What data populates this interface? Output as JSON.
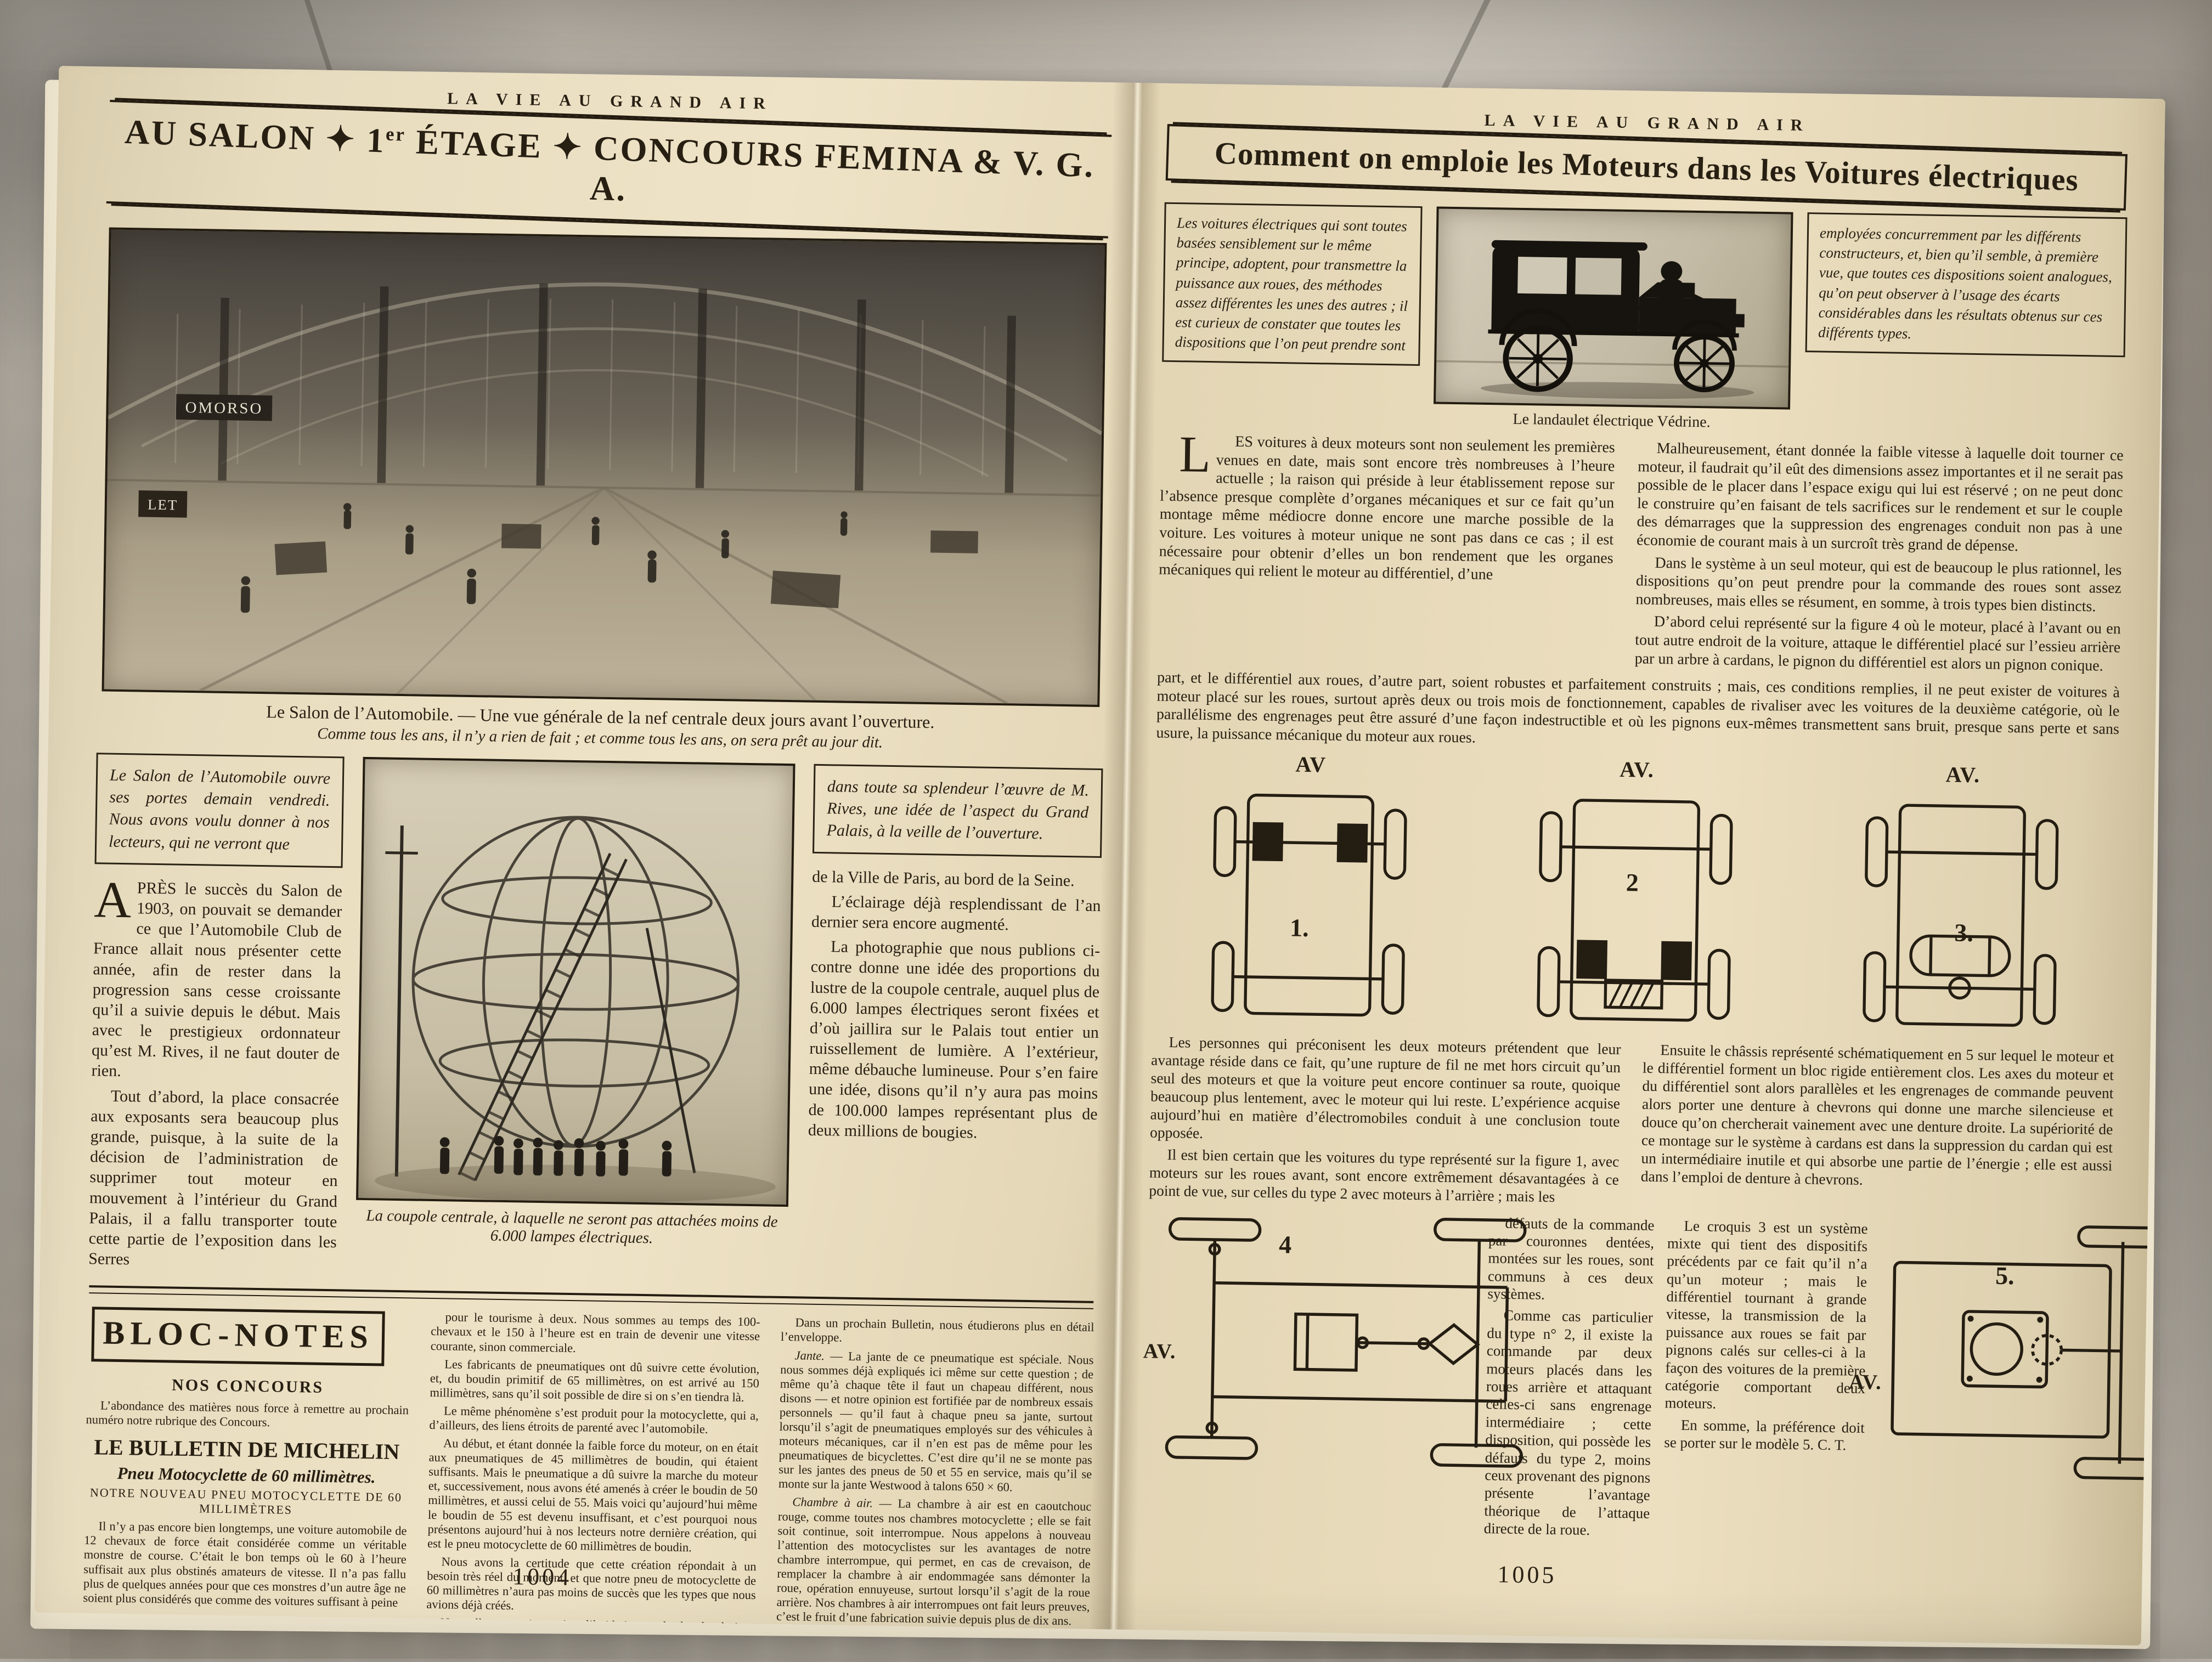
{
  "left_page": {
    "masthead": "LA VIE AU GRAND AIR",
    "title_p1": "AU SALON ✦ 1",
    "title_sup": "er",
    "title_p2": " ÉTAGE ✦ CONCOURS FEMINA & V. G. A.",
    "photo1": {
      "sign1": "OMORSO",
      "sign2": "LET",
      "caption_main": "Le Salon de l’Automobile. — Une vue générale de la nef centrale deux jours avant l’ouverture.",
      "caption_sub": "Comme tous les ans, il n’y a rien de fait ; et comme tous les ans, on sera prêt au jour dit."
    },
    "intro_box_left": "Le Salon de l’Automobile ouvre ses portes demain vendredi. Nous avons voulu donner à nos lecteurs, qui ne verront que",
    "intro_box_right": "dans toute sa splendeur l’œuvre de M. Rives, une idée de l’aspect du Grand Palais, à la veille de l’ouverture.",
    "article": {
      "dropcap": "A",
      "p1_rest": "PRÈS le succès du Salon de 1903, on pouvait se demander ce que l’Automobile Club de France allait nous présenter cette année, afin de rester dans la progression sans cesse croissante qu’il a suivie depuis le début. Mais avec le prestigieux ordonnateur qu’est M. Rives, il ne faut douter de rien.",
      "p2": "Tout d’abord, la place consacrée aux exposants sera beaucoup plus grande, puisque, à la suite de la décision de l’administration de supprimer tout moteur en mouvement à l’intérieur du Grand Palais, il a fallu transporter toute cette partie de l’exposition dans les Serres",
      "right_p1": "de la Ville de Paris, au bord de la Seine.",
      "right_p2": "L’éclairage déjà resplendissant de l’an dernier sera encore augmenté.",
      "right_p3": "La photographie que nous publions ci-contre donne une idée des proportions du lustre de la coupole centrale, auquel plus de 6.000 lampes électriques seront fixées et d’où jaillira sur le Palais tout entier un ruissellement de lumière. A l’extérieur, même débauche lumineuse. Pour s’en faire une idée, disons qu’il n’y aura pas moins de 100.000 lampes représentant plus de deux millions de bougies."
    },
    "photo2_caption": "La coupole centrale, à laquelle ne seront pas attachées moins de 6.000 lampes électriques.",
    "bloc_notes": {
      "title": "BLOC-NOTES",
      "h_concours": "NOS CONCOURS",
      "p_concours": "L’abondance des matières nous force à remettre au prochain numéro notre rubrique des Concours.",
      "h_michelin": "LE BULLETIN DE MICHELIN",
      "h_pneu": "Pneu Motocyclette de 60 millimètres.",
      "h_notre": "NOTRE NOUVEAU PNEU MOTOCYCLETTE DE 60 MILLIMÈTRES",
      "c1p1": "Il n’y a pas encore bien longtemps, une voiture automobile de 12 chevaux de force était considérée comme un véritable monstre de course. C’était le bon temps où le 60 à l’heure suffisait aux plus obstinés amateurs de vitesse. Il n’a pas fallu plus de quelques années pour que ces monstres d’un autre âge ne soient plus considérés que comme des voitures suffisant à peine",
      "c2p1": "pour le tourisme à deux. Nous sommes au temps des 100-chevaux et le 150 à l’heure est en train de devenir une vitesse courante, sinon commerciale.",
      "c2p2": "Les fabricants de pneumatiques ont dû suivre cette évolution, et, du boudin primitif de 65 millimètres, on est arrivé au 150 millimètres, sans qu’il soit possible de dire si on s’en tiendra là.",
      "c2p3": "Le même phénomène s’est produit pour la motocyclette, qui a, d’ailleurs, des liens étroits de parenté avec l’automobile.",
      "c2p4": "Au début, et étant donnée la faible force du moteur, on en était aux pneumatiques de 45 millimètres de boudin, qui étaient suffisants. Mais le pneumatique a dû suivre la marche du moteur et, successivement, nous avons été amenés à créer le boudin de 50 millimètres, et aussi celui de 55. Mais voici qu’aujourd’hui même le boudin de 55 est devenu insuffisant, et c’est pourquoi nous présentons aujourd’hui à nos lecteurs notre dernière création, qui est le pneu motocyclette de 60 millimètres de boudin.",
      "c2p5": "Nous avons la certitude que cette création répondait à un besoin très réel du moment, et que notre pneu de motocyclette de 60 millimètres n’aura pas moins de succès que les types que nous avions déjà créés.",
      "c2p6": "Nous allons examiner aujourd’hui la jante et la chambre à air.",
      "c3p1": "Dans un prochain Bulletin, nous étudierons plus en détail l’enveloppe.",
      "jante_label": "Jante.",
      "jante_text": " — La jante de ce pneumatique est spéciale. Nous nous sommes déjà expliqués ici même sur cette question ; de même qu’à chaque tête il faut un chapeau différent, nous disons — et notre opinion est fortifiée par de nombreux essais personnels — qu’il faut à chaque pneu sa jante, surtout lorsqu’il s’agit de pneumatiques employés sur des véhicules à moteurs mécaniques, car il n’en est pas de même pour les pneumatiques de bicyclettes. C’est dire qu’il ne se monte pas sur les jantes des pneus de 50 et 55 en service, mais qu’il se monte sur la jante Westwood à talons 650 × 60.",
      "chambre_label": "Chambre à air.",
      "chambre_text": " — La chambre à air est en caoutchouc rouge, comme toutes nos chambres motocyclette ; elle se fait soit continue, soit interrompue. Nous appelons à nouveau l’attention des motocyclistes sur les avantages de notre chambre interrompue, qui permet, en cas de crevaison, de remplacer la chambre à air endommagée sans démonter la roue, opération ennuyeuse, surtout lorsqu’il s’agit de la roue arrière. Nos chambres à air interrompues ont fait leurs preuves, c’est le fruit d’une fabrication suivie depuis plus de dix ans.",
      "signature": "Michelin et Cie."
    },
    "page_number": "1004"
  },
  "right_page": {
    "masthead": "LA VIE AU GRAND AIR",
    "title": "Comment on emploie les Moteurs dans les Voitures électriques",
    "intro_box_left": "Les voitures électriques qui sont toutes basées sensiblement sur le même principe, adoptent, pour transmettre la puissance aux roues, des méthodes assez différentes les unes des autres ; il est curieux de constater que toutes les dispositions que l’on peut prendre sont",
    "intro_box_right": "employées concurremment par les différents constructeurs, et, bien qu’il semble, à première vue, que toutes ces dispositions soient analogues, qu’on peut observer à l’usage des écarts considérables dans les résultats obtenus sur ces différents types.",
    "photo_caption": "Le landaulet électrique Védrine.",
    "article": {
      "dropcap": "L",
      "p1_rest": "ES voitures à deux moteurs sont non seulement les premières venues en date, mais sont encore très nombreuses à l’heure actuelle ; la raison qui préside à leur établissement repose sur l’absence presque complète d’organes mécaniques et sur ce fait qu’un montage même médiocre donne encore une marche possible de la voiture. Les voitures à moteur unique ne sont pas dans ce cas ; il est nécessaire pour obtenir d’elles un bon rendement que les organes mécaniques qui relient le moteur au différentiel, d’une",
      "right_p1": "Malheureusement, étant donnée la faible vitesse à laquelle doit tourner ce moteur, il faudrait qu’il eût des dimensions assez importantes et il ne serait pas possible de le placer dans l’espace exigu qui lui est réservé ; on ne peut donc le construire qu’en faisant de tels sacrifices sur le rendement et sur le couple des démarrages que la suppression des engrenages conduit non pas à une économie de courant mais à un surcroît très grand de dépense.",
      "right_p2": "Dans le système à un seul moteur, qui est de beaucoup le plus rationnel, les dispositions qu’on peut prendre pour la commande des roues sont assez nombreuses, mais elles se résument, en somme, à trois types bien distincts.",
      "right_p3": "D’abord celui représenté sur la figure 4 où le moteur, placé à l’avant ou en tout autre endroit de la voiture, attaque le différentiel placé sur l’essieu arrière par un arbre à cardans, le pignon du différentiel est alors un pignon conique.",
      "full_p": "part, et le différentiel aux roues, d’autre part, soient robustes et parfaitement construits ; mais, ces conditions remplies, il ne peut exister de voitures à moteur placé sur les roues, surtout après deux ou trois mois de fonctionnement, capables de rivaliser avec les voitures de la deuxième catégorie, où le parallélisme des engrenages peut être assuré d’une façon indestructible et où les pignons eux-mêmes transmettent sans bruit, presque sans perte et sans usure, la puissance mécanique du moteur aux roues.",
      "mid_left_p1": "Les personnes qui préconisent les deux moteurs prétendent que leur avantage réside dans ce fait, qu’une rupture de fil ne met hors circuit qu’un seul des moteurs et que la voiture peut encore continuer sa route, quoique beaucoup plus lentement, avec le moteur qui lui reste. L’expérience acquise aujourd’hui en matière d’électromobiles conduit à une conclusion toute opposée.",
      "mid_left_p2": "Il est bien certain que les voitures du type représenté sur la figure 1, avec moteurs sur les roues avant, sont encore extrêmement désavantagées à ce point de vue, sur celles du type 2 avec moteurs à l’arrière ; mais les",
      "mid_right_p1": "Ensuite le châssis représenté schématiquement en 5 sur lequel le moteur et le différentiel forment un bloc rigide entièrement clos. Les axes du moteur et du différentiel sont alors parallèles et les engrenages de commande peuvent alors porter une denture à chevrons qui donne une marche silencieuse et douce qu’on chercherait vainement avec une denture droite. La supériorité de ce montage sur le système à cardans est dans la suppression du cardan qui est un intermédiaire inutile et qui absorbe une partie de l’énergie ; elle est aussi dans l’emploi de denture à chevrons.",
      "bottom_a_p1": "défauts de la commande par couronnes dentées, montées sur les roues, sont communs à ces deux systèmes.",
      "bottom_a_p2": "Comme cas particulier du type n° 2, il existe la commande par deux moteurs placés dans les roues arrière et attaquant celles-ci sans engrenage intermédiaire ; cette disposition, qui possède les défauts du type 2, moins ceux provenant des pignons présente l’avantage théorique de l’attaque directe de la roue.",
      "bottom_b_p1": "Le croquis 3 est un système mixte qui tient des dispositifs précédents par ce fait qu’il n’a qu’un moteur ; mais le différentiel tournant à grande vitesse, la transmission de la puissance aux roues se fait par pignons calés sur celles-ci à la façon des voitures de la première catégorie comportant deux moteurs.",
      "bottom_b_p2": "En somme, la préférence doit se porter sur le modèle 5. C. T."
    },
    "diagrams": {
      "av1": "AV",
      "n1": "1.",
      "av2": "AV.",
      "n2": "2",
      "av3": "AV.",
      "n3": "3.",
      "av4": "AV.",
      "n4": "4",
      "av5": "AV.",
      "n5": "5."
    },
    "page_number": "1005"
  }
}
